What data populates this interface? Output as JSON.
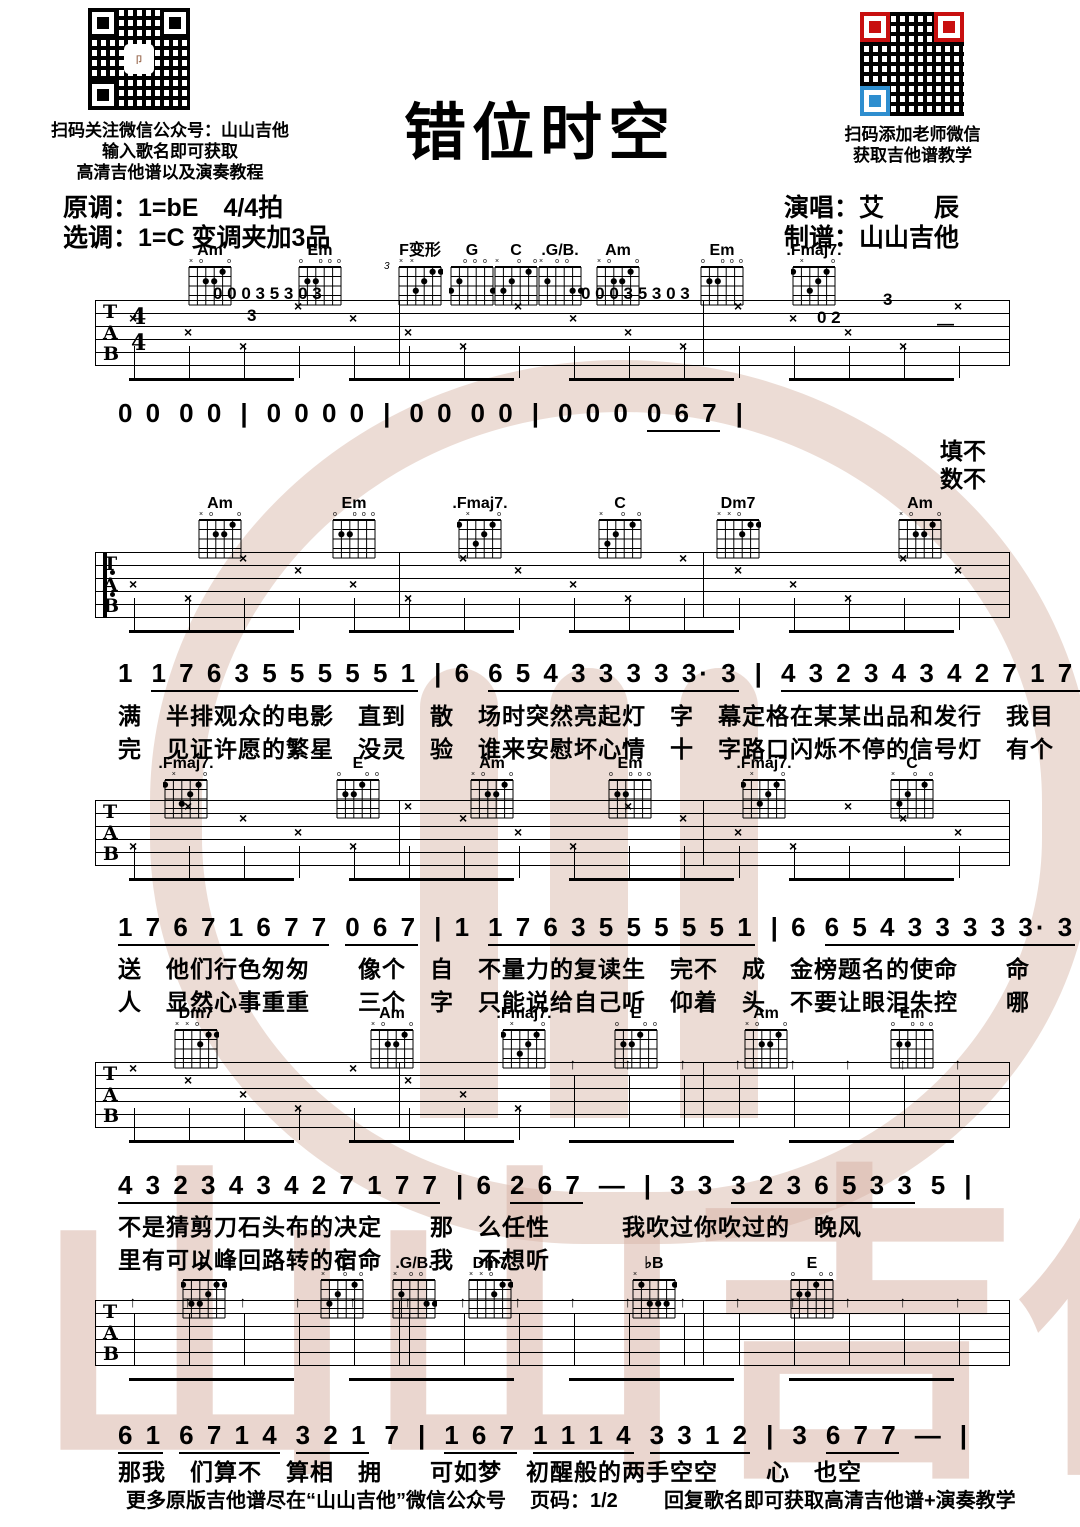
{
  "header": {
    "title": "错位时空",
    "qr_left_caption": [
      "扫码关注微信公众号：山山吉他",
      "输入歌名即可获取",
      "高清吉他谱以及演奏教程"
    ],
    "qr_right_caption": [
      "扫码添加老师微信",
      "获取吉他谱教学"
    ],
    "key_line1": "原调：1=bE　4/4拍",
    "key_line2": "选调：1=C 变调夹加3品",
    "credit_line1": "演唱：艾　　辰",
    "credit_line2": "制谱：山山吉他",
    "qr_logo_glyph": "卩"
  },
  "staff_labels": [
    "T",
    "A",
    "B"
  ],
  "time_signature": {
    "top": "4",
    "bottom": "4"
  },
  "chord_shapes": {
    "Am": "x02210",
    "Em": "022000",
    ".Fmaj7.": "1x3210",
    "C": "x32010",
    "G": "320003",
    ".G/B.": "x20033",
    "Dm7": "xx0211",
    "F": "133211",
    "♭B": "x13331",
    "E": "022100",
    "F变形": "xx3211"
  },
  "systems": [
    {
      "chords": [
        {
          "name": "Am",
          "x": 182
        },
        {
          "name": "Em",
          "x": 292
        },
        {
          "name": "F变形",
          "x": 392,
          "pos": "3"
        },
        {
          "name": "G",
          "x": 444
        },
        {
          "name": "C",
          "x": 488
        },
        {
          "name": ".G/B.",
          "x": 532
        },
        {
          "name": "Am",
          "x": 590
        },
        {
          "name": "Em",
          "x": 694
        },
        {
          "name": ".Fmaj7.",
          "x": 786
        }
      ],
      "tab_marks": [
        {
          "t": "0 0 0 3 5 3 0 3",
          "x": 118,
          "y": -16
        },
        {
          "t": "3",
          "x": 152,
          "y": 6
        },
        {
          "t": "0 0 0 3 5 3 0 3",
          "x": 486,
          "y": -16
        },
        {
          "t": "3",
          "x": 788,
          "y": -10
        },
        {
          "t": "0 2",
          "x": 722,
          "y": 8
        },
        {
          "t": "—",
          "x": 842,
          "y": 14
        }
      ],
      "melody": [
        {
          "t": "0 0",
          "u": false
        },
        {
          "t": "0 0",
          "u": false
        },
        {
          "t": "|",
          "u": false
        },
        {
          "t": "0 0 0 0",
          "u": false
        },
        {
          "t": "|",
          "u": false
        },
        {
          "t": "0 0",
          "u": false
        },
        {
          "t": "0 0",
          "u": false
        },
        {
          "t": "|",
          "u": false
        },
        {
          "t": "0 0 0",
          "u": false
        },
        {
          "t": "0 6 7",
          "u": true
        },
        {
          "t": "|",
          "u": false
        }
      ],
      "lyrics": [],
      "end_lyrics": [
        "填不",
        "数不"
      ]
    },
    {
      "chords": [
        {
          "name": "Am",
          "x": 192
        },
        {
          "name": "Em",
          "x": 326
        },
        {
          "name": ".Fmaj7.",
          "x": 452
        },
        {
          "name": "C",
          "x": 592
        },
        {
          "name": "Dm7",
          "x": 710
        },
        {
          "name": "Am",
          "x": 892
        }
      ],
      "tab_marks": [],
      "melody": [
        {
          "t": "1",
          "u": false
        },
        {
          "t": "1 7 6 3 5 5 5 5 5 1",
          "u": true
        },
        {
          "t": "| 6",
          "u": false
        },
        {
          "t": "6 5 4 3 3 3 3 3· 3",
          "u": true
        },
        {
          "t": "|",
          "u": false
        },
        {
          "t": "4 3 2 3 4 3 4 2 7 1 7 7 6 7",
          "u": true
        },
        {
          "t": "|",
          "u": false
        }
      ],
      "lyrics": [
        "满　半排观众的电影　直到　散　场时突然亮起灯　字　幕定格在某某出品和发行　我目",
        "完　见证许愿的繁星　没灵　验　谁来安慰坏心情　十　字路口闪烁不停的信号灯　有个"
      ],
      "end_lyrics": []
    },
    {
      "chords": [
        {
          "name": ".Fmaj7.",
          "x": 158
        },
        {
          "name": "E",
          "x": 330
        },
        {
          "name": "Am",
          "x": 464
        },
        {
          "name": "Em",
          "x": 602
        },
        {
          "name": ".Fmaj7.",
          "x": 736
        },
        {
          "name": "C",
          "x": 884
        }
      ],
      "tab_marks": [],
      "melody": [
        {
          "t": "1 7 6 7 1 6 7 7",
          "u": true
        },
        {
          "t": "0 6 7",
          "u": true
        },
        {
          "t": "| 1",
          "u": false
        },
        {
          "t": "1 7 6 3 5 5 5 5 5 1",
          "u": true
        },
        {
          "t": "| 6",
          "u": false
        },
        {
          "t": "6 5 4 3 3 3 3 3· 3",
          "u": true
        },
        {
          "t": "|",
          "u": false
        }
      ],
      "lyrics": [
        "送　他们行色匆匆　　像个　自　不量力的复读生　完不　成　金榜题名的使命　　命",
        "人　显然心事重重　　三个　字　只能说给自己听　仰着　头　不要让眼泪失控　　哪"
      ],
      "end_lyrics": []
    },
    {
      "chords": [
        {
          "name": "Dm7",
          "x": 168
        },
        {
          "name": "Am",
          "x": 364
        },
        {
          "name": ".Fmaj7.",
          "x": 496
        },
        {
          "name": "E",
          "x": 608
        },
        {
          "name": "Am",
          "x": 738
        },
        {
          "name": "Em",
          "x": 884
        }
      ],
      "tab_marks": [],
      "melody": [
        {
          "t": "4 3 2 3 4 3 4 2 7 1 7 7",
          "u": true
        },
        {
          "t": "| 6",
          "u": false
        },
        {
          "t": "2 6 7",
          "u": true
        },
        {
          "t": "—",
          "u": false
        },
        {
          "t": "|",
          "u": false
        },
        {
          "t": "3 3",
          "u": false
        },
        {
          "t": "3 2 3 6 5 3 3",
          "u": true
        },
        {
          "t": "5",
          "u": false
        },
        {
          "t": "|",
          "u": false
        }
      ],
      "lyrics": [
        "不是猜剪刀石头布的决定　　那　么任性　　　我吹过你吹过的　晚风",
        "里有可以峰回路转的宿命　　我　不想听"
      ],
      "end_lyrics": []
    },
    {
      "chords": [
        {
          "name": "F",
          "x": 176
        },
        {
          "name": "C",
          "x": 314
        },
        {
          "name": ".G/B.",
          "x": 386
        },
        {
          "name": "Dm7",
          "x": 462
        },
        {
          "name": "♭B",
          "x": 626
        },
        {
          "name": "E",
          "x": 784
        }
      ],
      "tab_marks": [],
      "melody": [
        {
          "t": "6 1",
          "u": true
        },
        {
          "t": "6 7 1 4",
          "u": true
        },
        {
          "t": "3 2 1",
          "u": true
        },
        {
          "t": "7",
          "u": false
        },
        {
          "t": "|",
          "u": false
        },
        {
          "t": "1 6 7",
          "u": true
        },
        {
          "t": "1 1 1 4",
          "u": true
        },
        {
          "t": "3 3 1 2",
          "u": true
        },
        {
          "t": "|",
          "u": false
        },
        {
          "t": "3",
          "u": false
        },
        {
          "t": "6 7 7",
          "u": true
        },
        {
          "t": "—",
          "u": false
        },
        {
          "t": "|",
          "u": false
        }
      ],
      "lyrics": [
        "那我　们算不　算相　拥　　可如梦　初醒般的两手空空　　心　也空"
      ],
      "end_lyrics": []
    }
  ],
  "watermark_chars": [
    "山",
    "山",
    "吉",
    "他"
  ],
  "footer": {
    "left": "更多原版吉他谱尽在“山山吉他”微信公众号",
    "center": "页码：1/2",
    "right": "回复歌名即可获取高清吉他谱+演奏教学"
  }
}
